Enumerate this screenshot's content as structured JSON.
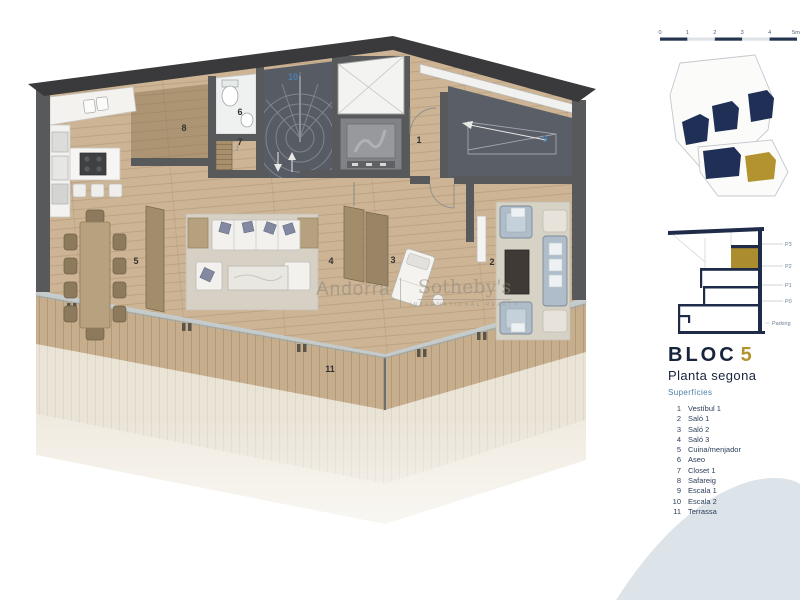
{
  "document": {
    "type": "floor-plan"
  },
  "scalebar": {
    "labels": [
      "0",
      "1",
      "2",
      "3",
      "4",
      "5m"
    ]
  },
  "section": {
    "labels": [
      "P3",
      "P2",
      "P1",
      "P0",
      "Parking"
    ]
  },
  "title": {
    "block": "BLOC",
    "number": "5",
    "subtitle": "Planta segona"
  },
  "legend": {
    "heading": "Superfícies",
    "items": [
      {
        "num": "1",
        "label": "Vestíbul 1"
      },
      {
        "num": "2",
        "label": "Saló 1"
      },
      {
        "num": "3",
        "label": "Saló 2"
      },
      {
        "num": "4",
        "label": "Saló 3"
      },
      {
        "num": "5",
        "label": "Cuina/menjador"
      },
      {
        "num": "6",
        "label": "Aseo"
      },
      {
        "num": "7",
        "label": "Closet 1"
      },
      {
        "num": "8",
        "label": "Safareig"
      },
      {
        "num": "9",
        "label": "Escala 1"
      },
      {
        "num": "10",
        "label": "Escala 2"
      },
      {
        "num": "11",
        "label": "Terrassa"
      }
    ]
  },
  "watermark": {
    "left": "Andorra",
    "brand": "Sotheby's",
    "brand_sub": "INTERNATIONAL REALTY"
  },
  "colors": {
    "navy": "#1f2c49",
    "gold": "#b3932f",
    "label_blue": "#4a7fa8",
    "wall_gray": "#58595b",
    "roof_dark": "#3a3a3c",
    "wood": "#ccb494",
    "deck": "#c6ae8c",
    "pale_terrace": "#eae4d7",
    "stair_dark": "#575c64",
    "wave": "#dce3e9"
  }
}
